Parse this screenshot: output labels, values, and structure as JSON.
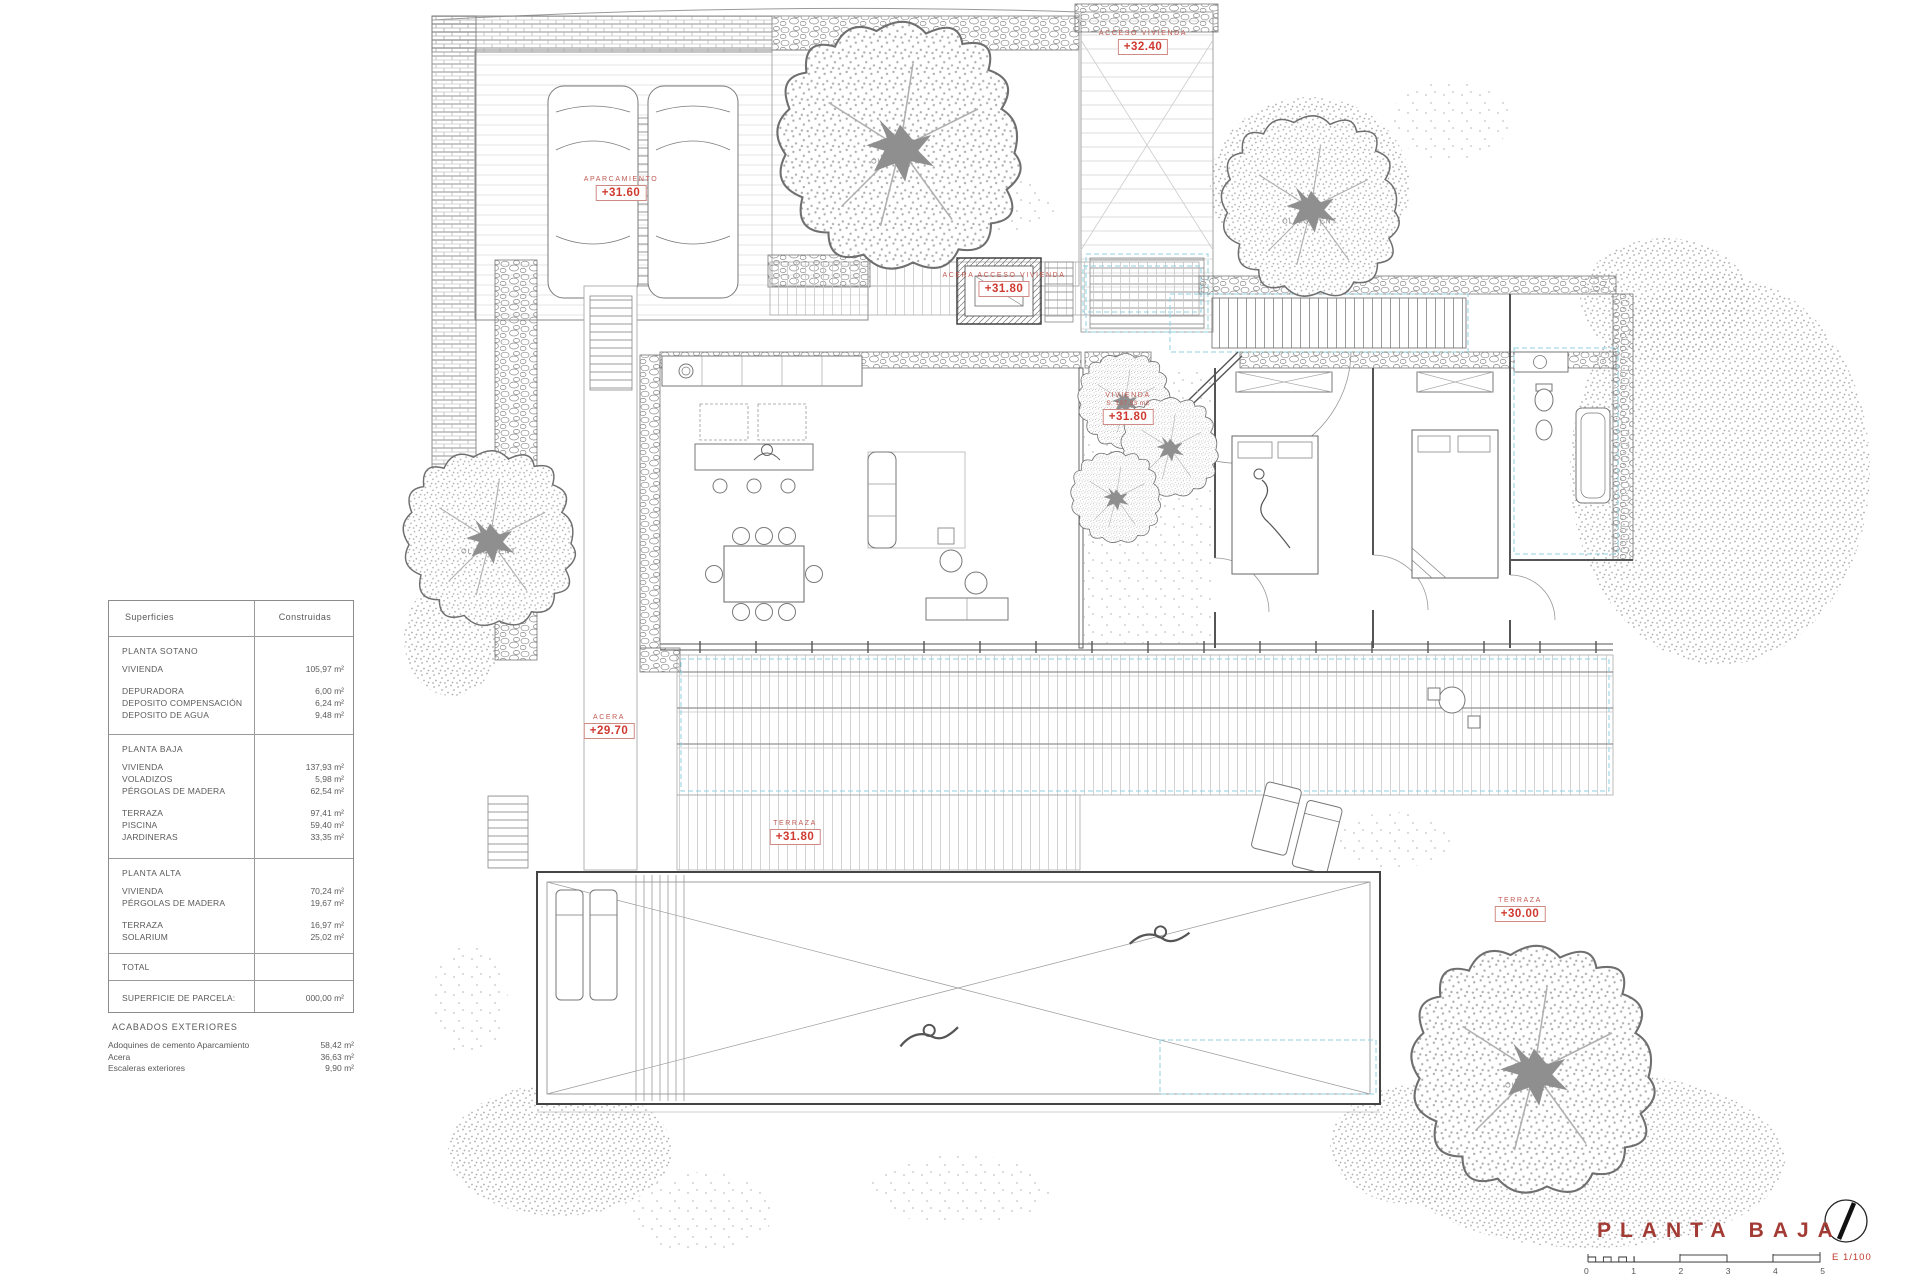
{
  "meta": {
    "title_label": "PLANTA BAJA",
    "scale_label": "E 1/100",
    "accent_red": "#cf3a30",
    "cyan_dash": "#8fd2e2"
  },
  "areas_table": {
    "headers": {
      "col1": "Superficies",
      "col2": "Construidas"
    },
    "sections": [
      {
        "title": "PLANTA SOTANO",
        "rows": [
          {
            "label": "VIVIENDA",
            "value": "105,97 m²"
          },
          {
            "label": "DEPURADORA",
            "value": "6,00 m²"
          },
          {
            "label": "DEPOSITO COMPENSACIÓN",
            "value": "6,24 m²"
          },
          {
            "label": "DEPOSITO DE AGUA",
            "value": "9,48 m²"
          }
        ]
      },
      {
        "title": "PLANTA BAJA",
        "rows": [
          {
            "label": "VIVIENDA",
            "value": "137,93 m²"
          },
          {
            "label": "VOLADIZOS",
            "value": "5,98 m²"
          },
          {
            "label": "PÉRGOLAS DE MADERA",
            "value": "62,54 m²"
          },
          {
            "label": "TERRAZA",
            "value": "97,41 m²"
          },
          {
            "label": "PISCINA",
            "value": "59,40 m²"
          },
          {
            "label": "JARDINERAS",
            "value": "33,35 m²"
          }
        ]
      },
      {
        "title": "PLANTA ALTA",
        "rows": [
          {
            "label": "VIVIENDA",
            "value": "70,24 m²"
          },
          {
            "label": "PÉRGOLAS DE MADERA",
            "value": "19,67 m²"
          },
          {
            "label": "TERRAZA",
            "value": "16,97 m²"
          },
          {
            "label": "SOLARIUM",
            "value": "25,02 m²"
          }
        ]
      }
    ],
    "total_label": "TOTAL",
    "parcel_label": "SUPERFICIE DE PARCELA:",
    "parcel_value": "000,00 m²"
  },
  "exterior": {
    "title": "ACABADOS EXTERIORES",
    "rows": [
      {
        "label": "Adoquines de cemento Aparcamiento",
        "value": "58,42 m²"
      },
      {
        "label": "Acera",
        "value": "36,63 m²"
      },
      {
        "label": "Escaleras exteriores",
        "value": "9,90 m²"
      }
    ]
  },
  "markers": [
    {
      "label": "APARCAMIENTO",
      "value": "+31.60"
    },
    {
      "label": "ACCESO VIVIENDA",
      "value": "+32.40"
    },
    {
      "label": "ACERA ACCESO VIVIENDA",
      "value": "+31.80"
    },
    {
      "label": "VIVIENDA",
      "sublabel": "S: 137,93 m2",
      "value": "+31.80"
    },
    {
      "label": "ACERA",
      "value": "+29.70"
    },
    {
      "label": "TERRAZA",
      "value": "+31.80"
    },
    {
      "label": "TERRAZA",
      "value": "+30.00"
    }
  ],
  "tree_label": "OLIVO CENT.",
  "scalebar": {
    "numbers": [
      "0",
      "1",
      "2",
      "3",
      "4",
      "5"
    ]
  }
}
